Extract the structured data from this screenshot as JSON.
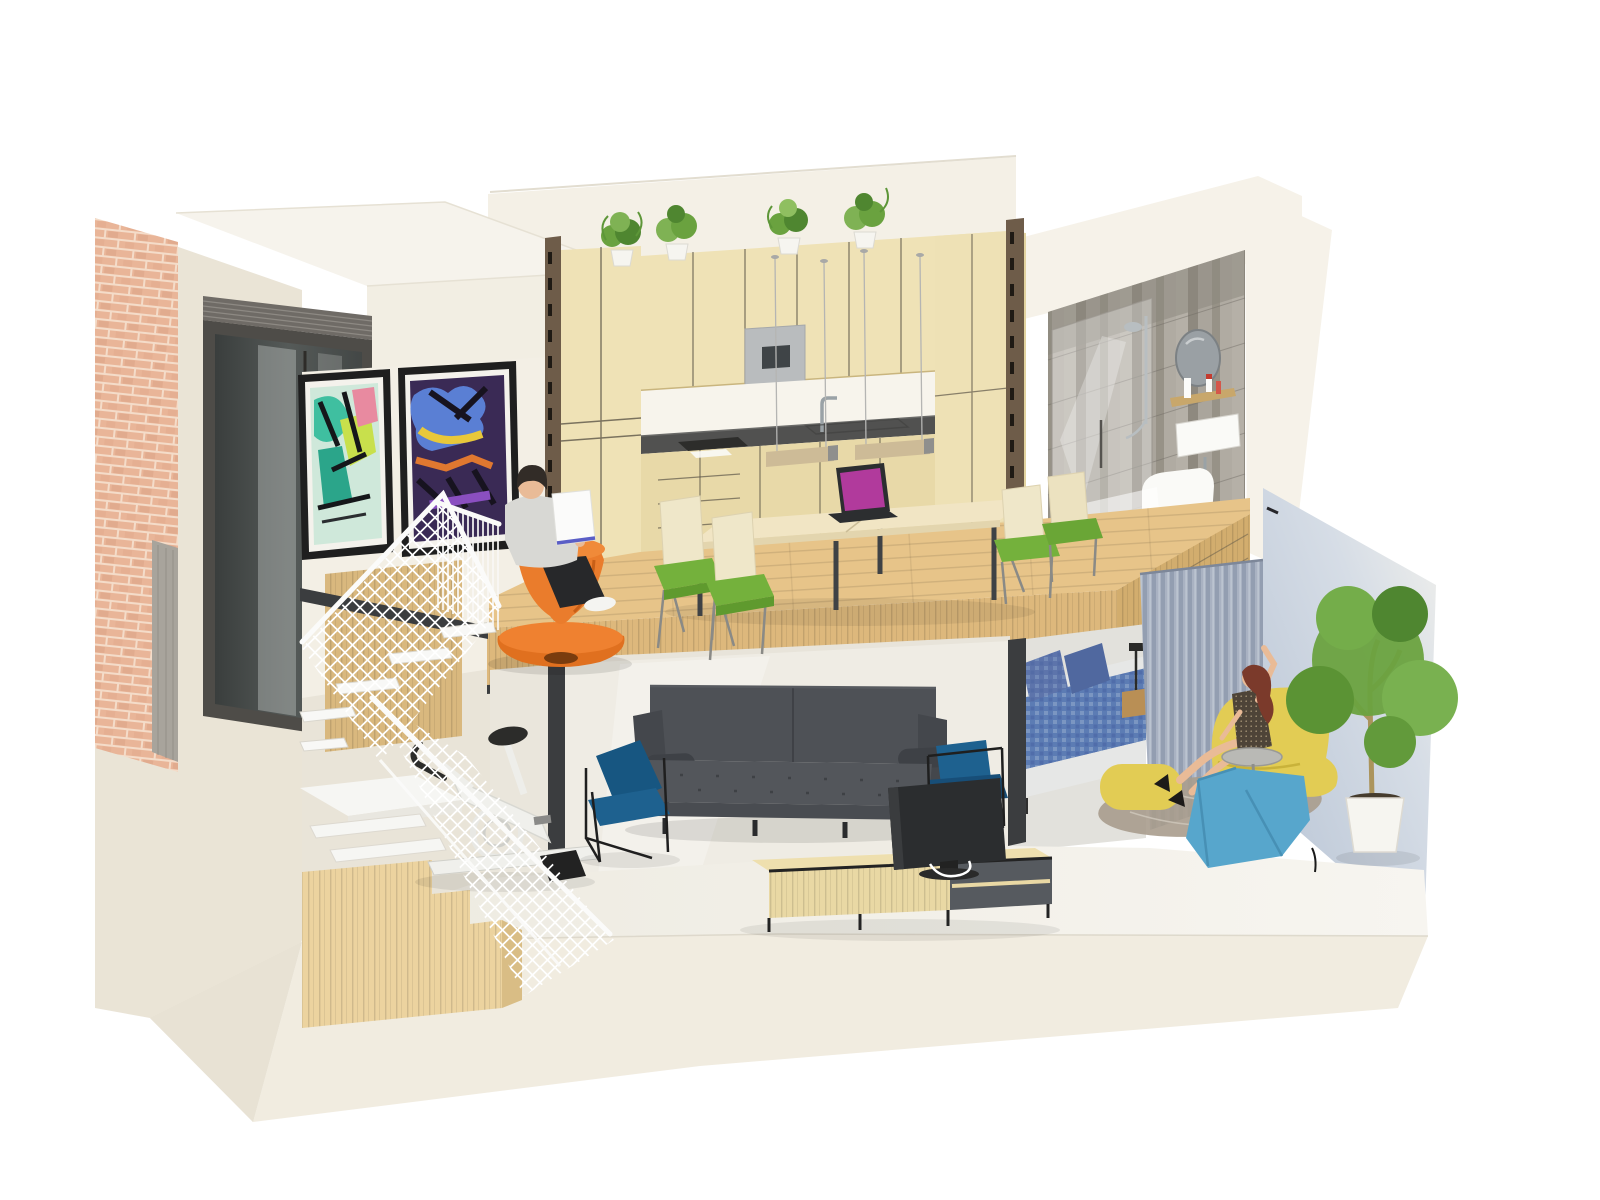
{
  "scene": {
    "kind": "3d-cutaway-interior-render",
    "subject": "two-level loft apartment dollhouse section",
    "people_visible": 2,
    "rooms": [
      {
        "name": "kitchen-dining-mezzanine",
        "objects": [
          "wood-cabinets",
          "built-in-coffee-machine",
          "sink-faucet",
          "induction-hob",
          "potted-plants-row",
          "two-linear-pendant-lights",
          "double-work-table",
          "four-green-seat-chairs",
          "laptop-magenta-screen",
          "orange-spun-chair",
          "man-reading-book",
          "white-mesh-balustrade"
        ]
      },
      {
        "name": "living-room-lower",
        "objects": [
          "gray-sofa",
          "two-blue-wire-armchairs",
          "tv-on-media-console",
          "white-exercise-bike",
          "floating-stair-with-wood-base",
          "white-diamond-mesh-railing"
        ]
      },
      {
        "name": "bedroom-nook",
        "objects": [
          "double-bed-blue-bedding",
          "patterned-pillows",
          "black-bedside-lamp",
          "striped-gray-curtain"
        ]
      },
      {
        "name": "bathroom-upper-right",
        "objects": [
          "gray-tiled-walls",
          "glass-shower",
          "chrome-shower-column",
          "round-mirror",
          "wood-shelf-with-bottles",
          "wall-hung-basin",
          "wall-hung-toilet",
          "wood-floor"
        ]
      },
      {
        "name": "lounge-corner-right",
        "objects": [
          "woman-waving",
          "yellow-lounge-chair",
          "yellow-pouf",
          "blue-angular-lounge-chair",
          "round-side-table",
          "area-rug",
          "potted-tree"
        ]
      },
      {
        "name": "facade-left",
        "objects": [
          "brick-pier",
          "dark-window-with-louvers",
          "insulation-cut-layer",
          "two-graffiti-posters"
        ]
      }
    ]
  },
  "palette": {
    "bg": "#ffffff",
    "wall": "#f4f0e6",
    "wall_dark": "#eae4d6",
    "wall_deep": "#e3ddcf",
    "slab": "#f1ece0",
    "floor_low": "#f2efe7",
    "shadow_blue": "#b7c3d4",
    "brick": "#e9b598",
    "brick_mortar": "#f4dcc9",
    "window_frame": "#4e4c48",
    "glass": "#3f4342",
    "wood_floor": "#e7c489",
    "wood_grain": "#c9a765",
    "wood_fascia": "#ddb87c",
    "wood_stair": "#ecd39f",
    "cabinet": "#efe2b6",
    "cabinet_base": "#e8d9a8",
    "counter": "#515150",
    "machine": "#b9bcbe",
    "steel": "#3b3d3f",
    "bronze": "#6e5c49",
    "chrome": "#9aa2a6",
    "pendant": "#cdbb97",
    "table": "#f1e5c4",
    "chair_cream": "#efe7c9",
    "chair_green": "#74b13c",
    "laptop_screen": "#b13a9c",
    "laptop_body": "#2c2e30",
    "orange": "#ea7c2c",
    "orange_deep": "#c85f17",
    "shirt": "#d8d8d4",
    "skin": "#e9bb97",
    "hair": "#322c27",
    "book_blue": "#5a5ec6",
    "sofa": "#4e5156",
    "sofa_seat": "#53565b",
    "chair_blue": "#1e618f",
    "tv": "#2b2d2f",
    "console_wood": "#e9d8a4",
    "frame_black": "#232323",
    "bed_blue": "#5c7cb4",
    "bed_pillow": "#5d74ab",
    "bed_white": "#e6e7e6",
    "curtain": "#a9b2c2",
    "curtain_dark": "#939eb1",
    "tile": "#a49f96",
    "fixture": "#fafaf7",
    "mesh": "#ffffff",
    "bike": "#f0f0ec",
    "dark": "#2c2c2a",
    "yellow": "#e2cc54",
    "lounge_blue": "#57a6cc",
    "rug": "#a89c8d",
    "leaf": "#6aa23f",
    "leaf_dark": "#4f8630",
    "trunk": "#ab945c",
    "pot": "#f6f5f0",
    "hair_red": "#7b3a2b",
    "dress": "#4e4438"
  }
}
